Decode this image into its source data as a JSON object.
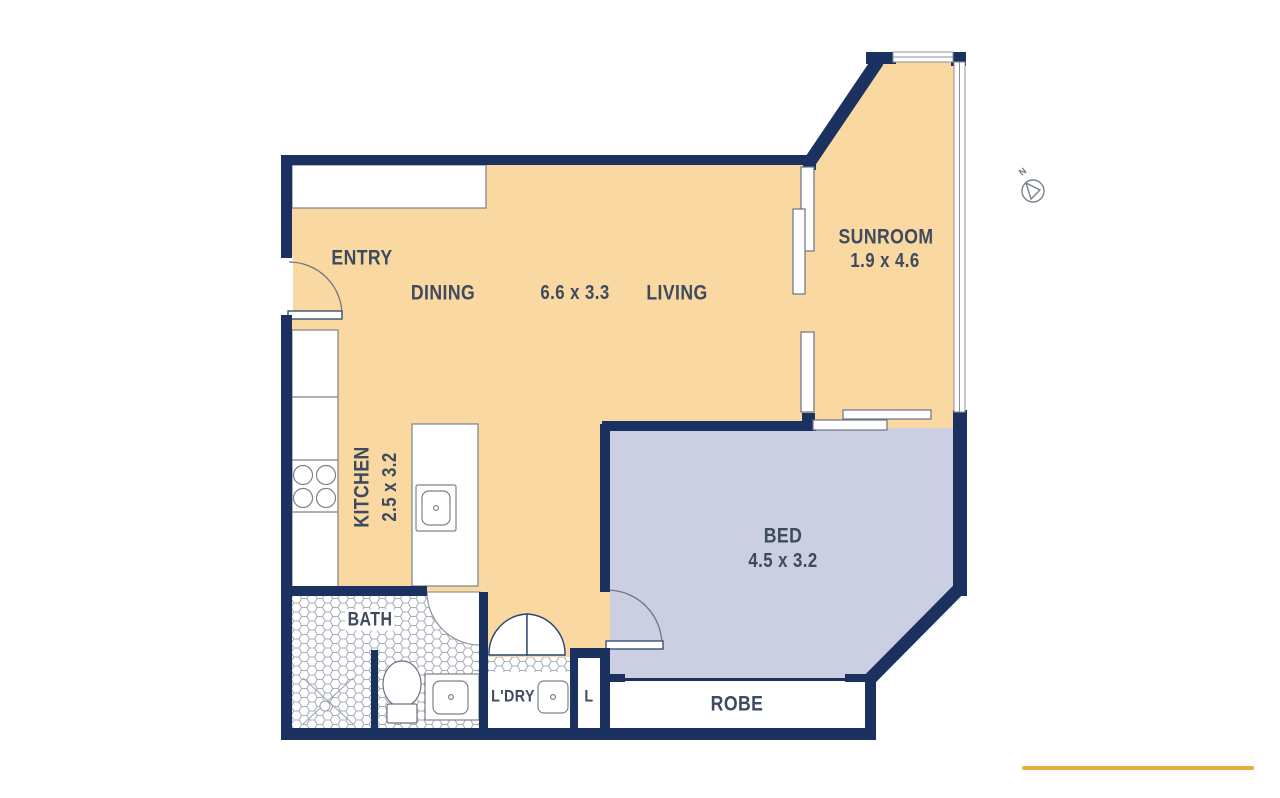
{
  "title": "Apartment floor plan",
  "labels": {
    "entry": "ENTRY",
    "dining": "DINING",
    "dining_living_dims": "6.6 x 3.3",
    "living": "LIVING",
    "sunroom": "SUNROOM",
    "sunroom_dims": "1.9 x 4.6",
    "kitchen": "KITCHEN",
    "kitchen_dims": "2.5 x 3.2",
    "bed": "BED",
    "bed_dims": "4.5 x 3.2",
    "bath": "BATH",
    "laundry": "L'DRY",
    "linen": "L",
    "robe": "ROBE",
    "compass_north": "N"
  },
  "rooms": [
    {
      "name": "ENTRY",
      "dimensions": ""
    },
    {
      "name": "DINING / LIVING",
      "dimensions": "6.6 x 3.3"
    },
    {
      "name": "SUNROOM",
      "dimensions": "1.9 x 4.6"
    },
    {
      "name": "KITCHEN",
      "dimensions": "2.5 x 3.2"
    },
    {
      "name": "BED",
      "dimensions": "4.5 x 3.2"
    },
    {
      "name": "BATH",
      "dimensions": ""
    },
    {
      "name": "L'DRY",
      "dimensions": ""
    },
    {
      "name": "L",
      "dimensions": ""
    },
    {
      "name": "ROBE",
      "dimensions": ""
    }
  ],
  "colors": {
    "wall": "#1b3261",
    "floor": "#f9d8a1",
    "bedroom_floor": "#cccee1",
    "label_text": "#3e4a5e",
    "accent_line": "#ecaa3f",
    "tile_stroke": "#a8aeb7"
  }
}
